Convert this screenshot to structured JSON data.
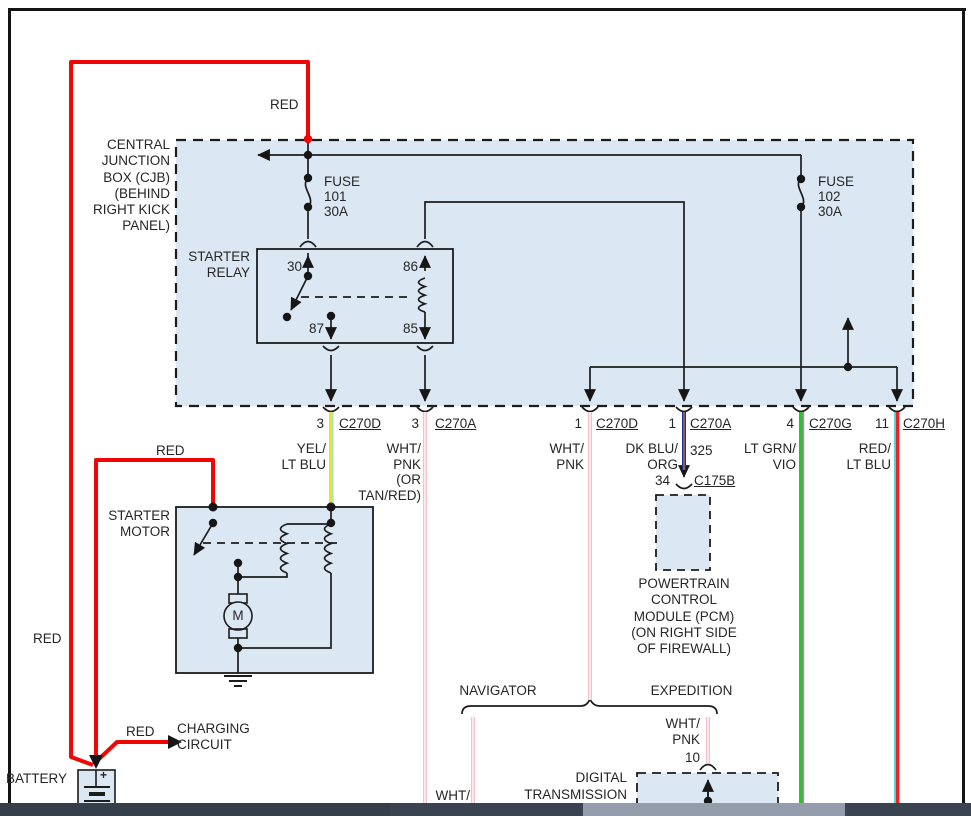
{
  "colors": {
    "box_fill": "#dbe8f4",
    "red_wire": "#f10505",
    "yellow": "#f2e30e",
    "lt_blue": "#9fe8df",
    "pink": "#f3bfcb",
    "white_stripe": "#ffffff",
    "dk_blue": "#203099",
    "orange": "#f08a1e",
    "green": "#1ecb1e",
    "violet": "#f055f0",
    "red2": "#ee2222",
    "cyan": "#52dce6",
    "scroll_track": "#3a4350",
    "scroll_seg": "#353f4a",
    "scroll_thumb": "#939dab"
  },
  "cjb": {
    "lines": [
      "CENTRAL",
      "JUNCTION",
      "BOX (CJB)",
      "(BEHIND",
      "RIGHT KICK",
      "PANEL)"
    ]
  },
  "fuses": {
    "f101": [
      "FUSE",
      "101",
      "30A"
    ],
    "f102": [
      "FUSE",
      "102",
      "30A"
    ]
  },
  "relay": {
    "lines": [
      "STARTER",
      "RELAY"
    ],
    "pin30": "30",
    "pin86": "86",
    "pin87": "87",
    "pin85": "85"
  },
  "connector_row": {
    "c1_pin": "3",
    "c1_name": "C270D",
    "c2_pin": "3",
    "c2_name": "C270A",
    "c3_pin": "1",
    "c3_name": "C270D",
    "c4_pin": "1",
    "c4_name": "C270A",
    "c5_pin": "4",
    "c5_name": "C270G",
    "c6_pin": "11",
    "c6_name": "C270H"
  },
  "wire_labels": {
    "yel": [
      "YEL/",
      "LT BLU"
    ],
    "wht_pnk_tan": [
      "WHT/",
      "PNK",
      "(OR",
      "TAN/RED)"
    ],
    "wht_pnk": [
      "WHT/",
      "PNK"
    ],
    "dk_blu": [
      "DK BLU/",
      "ORG"
    ],
    "circuit": "325",
    "lt_grn": [
      "LT GRN/",
      "VIO"
    ],
    "red_lt_blu": [
      "RED/",
      "LT BLU"
    ]
  },
  "pcm": {
    "pin": "34",
    "connector": "C175B",
    "lines": [
      "POWERTRAIN",
      "CONTROL",
      "MODULE (PCM)",
      "(ON RIGHT SIDE",
      "OF FIREWALL)"
    ]
  },
  "motor": {
    "lines": [
      "STARTER",
      "MOTOR"
    ],
    "symbol": "M"
  },
  "battery": {
    "label": "BATTERY",
    "plus": "+"
  },
  "charging": {
    "wire": "RED",
    "lines": [
      "CHARGING",
      "CIRCUIT"
    ]
  },
  "red_labels": {
    "top": "RED",
    "left": "RED",
    "motor_feed": "RED"
  },
  "variants": {
    "left": "NAVIGATOR",
    "right": "EXPEDITION"
  },
  "tr_sensor": {
    "wire": [
      "WHT/",
      "PNK"
    ],
    "pin": "10",
    "lines": [
      "DIGITAL",
      "TRANSMISSION"
    ]
  },
  "bottom_partial_label": "WHT/"
}
